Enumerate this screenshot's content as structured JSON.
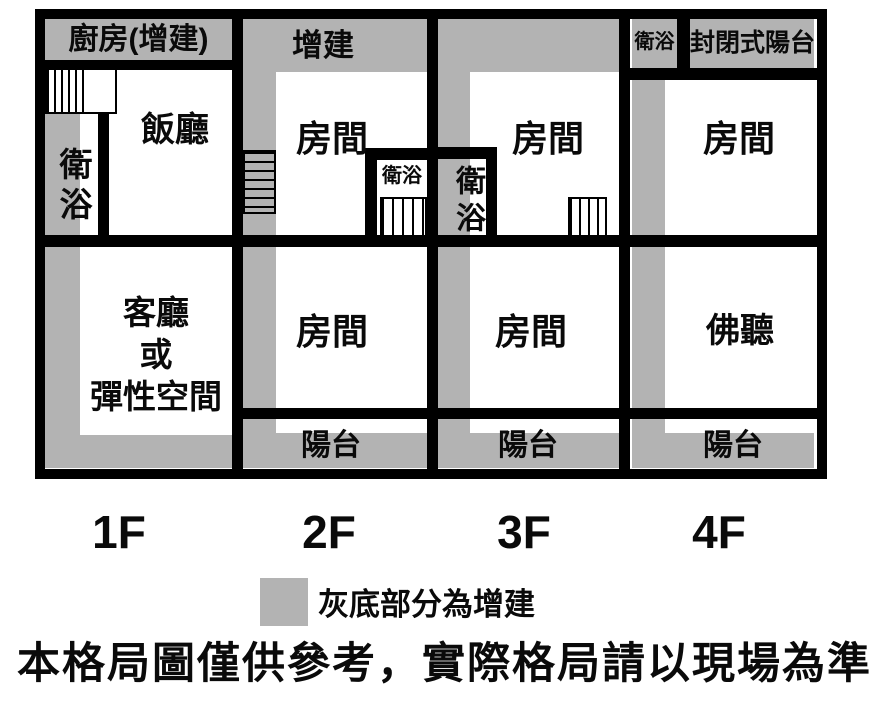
{
  "floors": {
    "f1": {
      "label": "1F",
      "kitchen": "廚房(增建)",
      "dining": "飯廳",
      "bath": "衛浴",
      "living_line1": "客廳",
      "living_line2": "或",
      "living_line3": "彈性空間"
    },
    "f2": {
      "label": "2F",
      "addition": "增建",
      "room_upper": "房間",
      "bath": "衛浴",
      "room_lower": "房間",
      "balcony": "陽台"
    },
    "f3": {
      "label": "3F",
      "bath": "衛浴",
      "room_upper": "房間",
      "room_lower": "房間",
      "balcony": "陽台"
    },
    "f4": {
      "label": "4F",
      "bath": "衛浴",
      "enclosed_balcony": "封閉式陽台",
      "room": "房間",
      "buddha_hall": "佛聽",
      "balcony": "陽台"
    }
  },
  "legend": {
    "label": "灰底部分為增建"
  },
  "disclaimer": "本格局圖僅供參考，實際格局請以現場為準",
  "colors": {
    "addition_gray": "#b3b3b3",
    "wall_black": "#000000",
    "background": "#ffffff"
  }
}
